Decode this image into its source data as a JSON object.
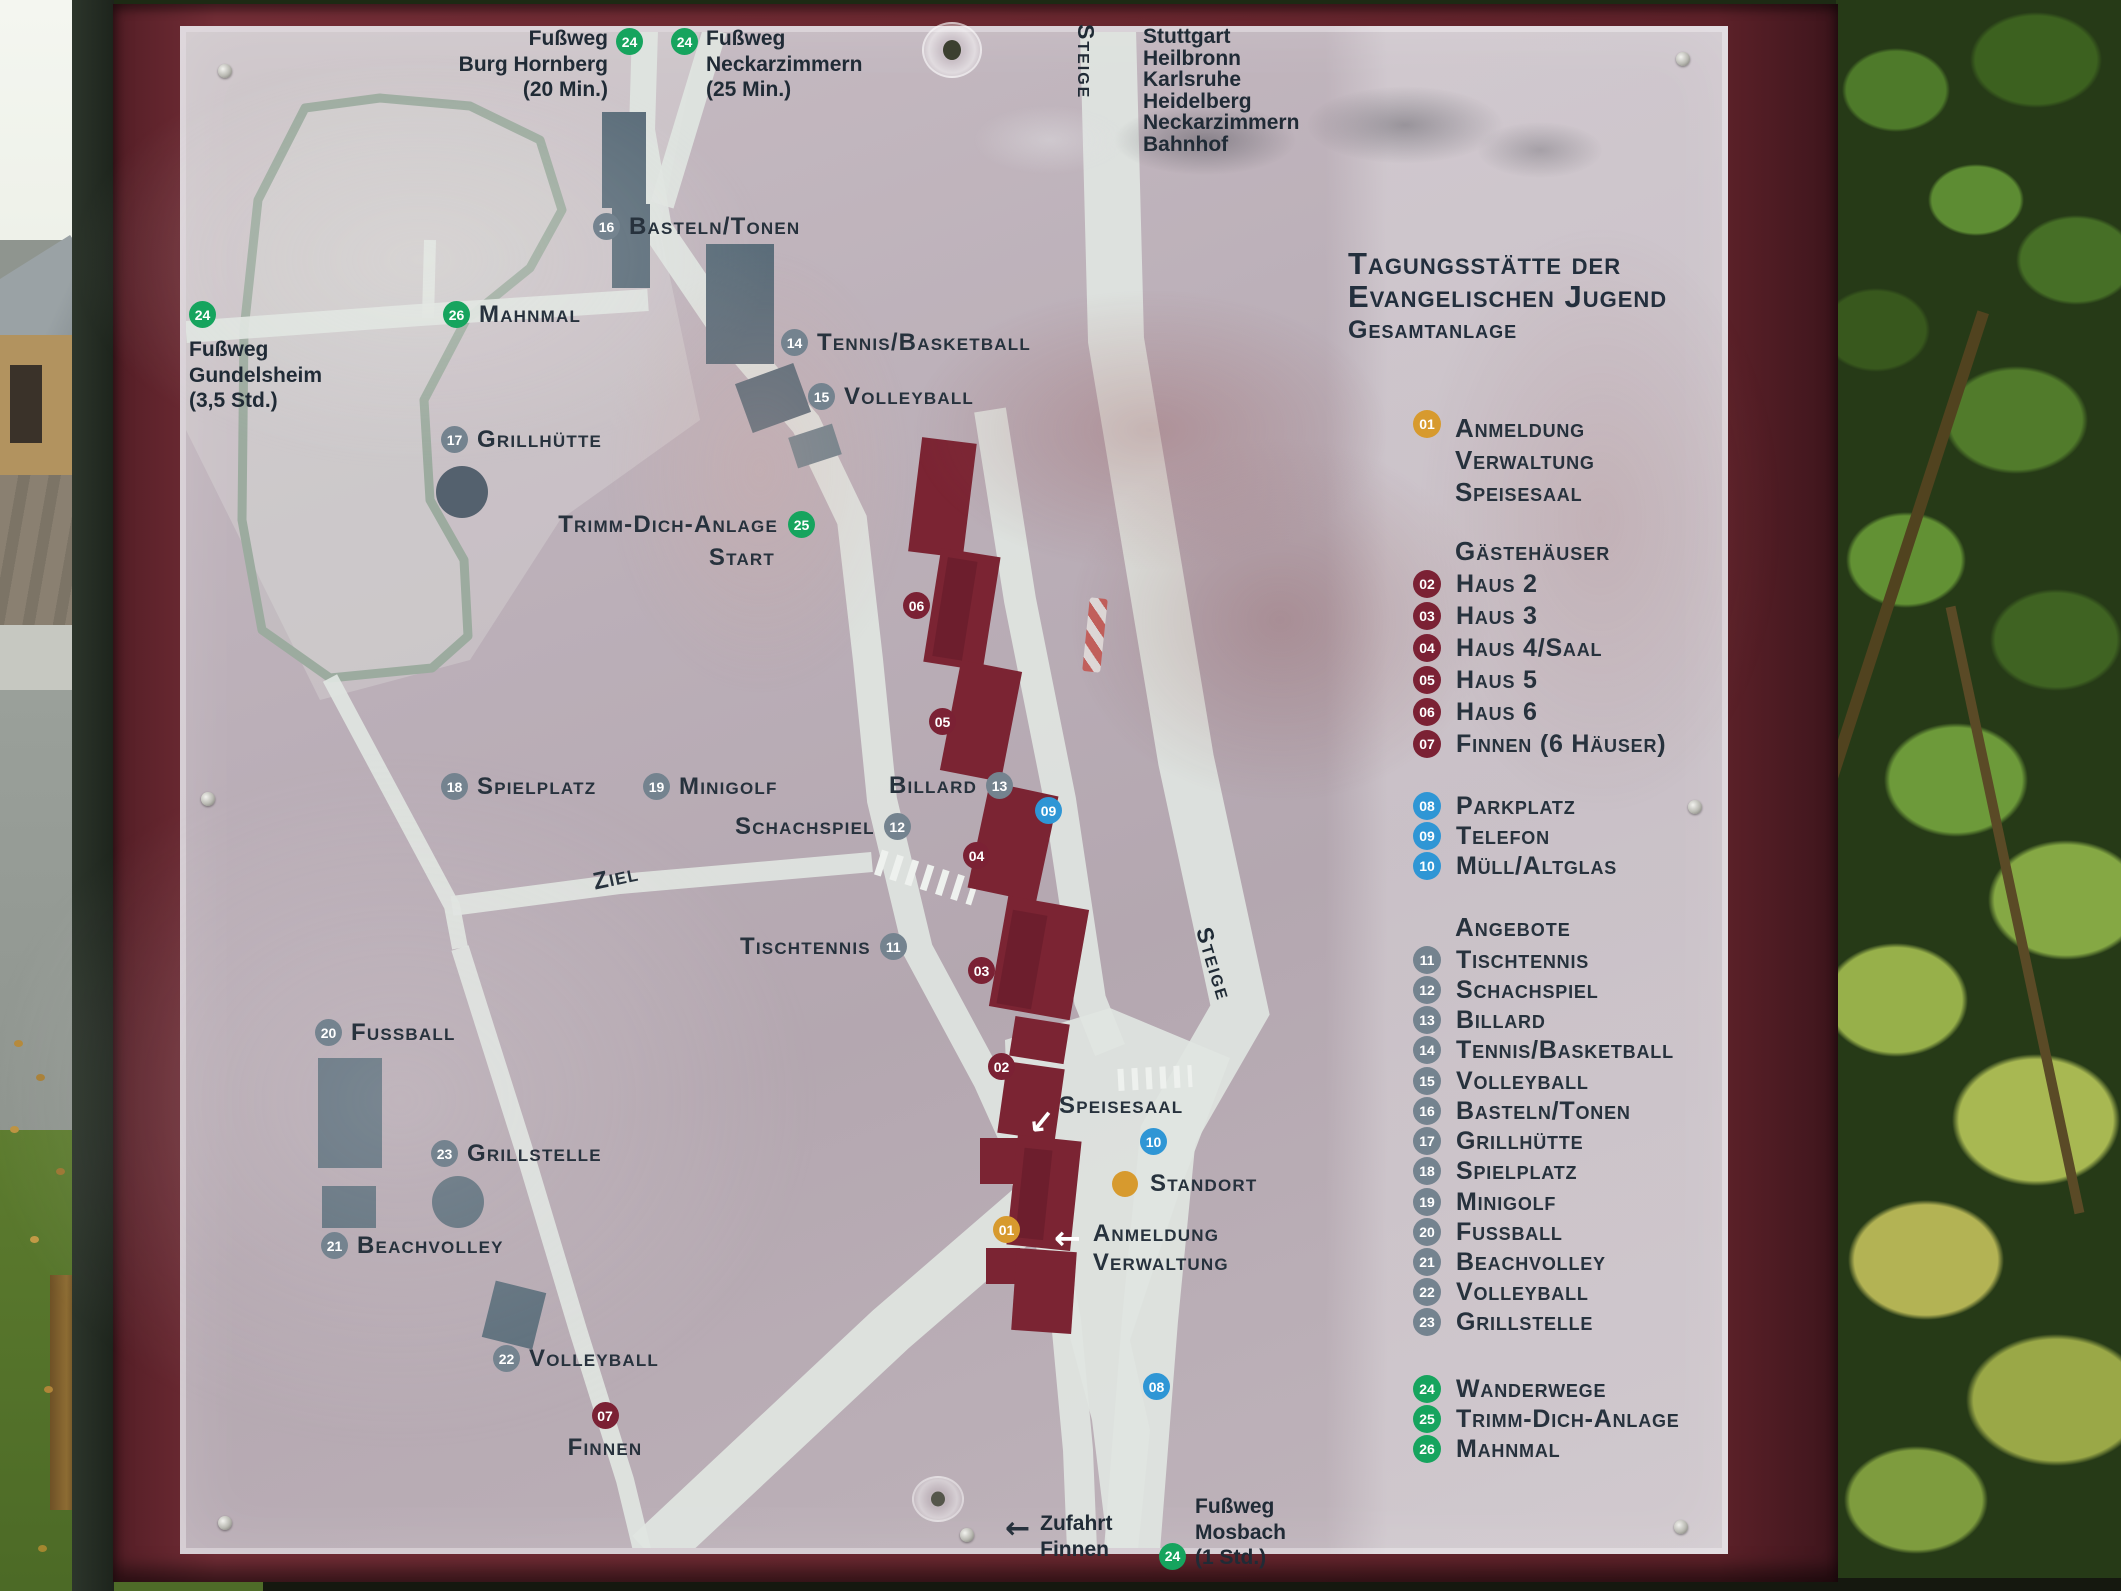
{
  "colors": {
    "frame": "#6b2830",
    "panel": "#bbafb8",
    "building_red": "#7b2433",
    "building_gray": "#5b6d7a",
    "road": "#dfe5e1",
    "badge_red": "#7b2134",
    "badge_blue": "#2f96d5",
    "badge_gray": "#74838f",
    "badge_green": "#16a45e",
    "badge_orange": "#d79a2e",
    "text": "#27323d"
  },
  "sign_title": {
    "line1": "Tagungsstätte der",
    "line2": "Evangelischen Jugend",
    "subtitle": "Gesamtanlage"
  },
  "streets": {
    "steige_top": "Steige",
    "steige_mid": "Steige",
    "destinations": [
      "Stuttgart",
      "Heilbronn",
      "Karlsruhe",
      "Heidelberg",
      "Neckarzimmern",
      "Bahnhof"
    ]
  },
  "walks": {
    "hornberg": {
      "num": "24",
      "lines": [
        "Fußweg",
        "Burg Hornberg",
        "(20 Min.)"
      ]
    },
    "neckarzimmern": {
      "num": "24",
      "lines": [
        "Fußweg",
        "Neckarzimmern",
        "(25 Min.)"
      ]
    },
    "gundelsheim": {
      "num": "24",
      "lines": [
        "Fußweg",
        "Gundelsheim",
        "(3,5 Std.)"
      ]
    },
    "mosbach": {
      "num": "24",
      "lines": [
        "Fußweg",
        "Mosbach",
        "(1 Std.)"
      ]
    },
    "zufahrt": {
      "arrow": "←",
      "lines": [
        "Zufahrt",
        "Finnen"
      ]
    }
  },
  "map": {
    "labels": {
      "mahnmal": {
        "num": "26",
        "text": "Mahnmal"
      },
      "basteln": {
        "num": "16",
        "text": "Basteln/Tonen"
      },
      "tennis": {
        "num": "14",
        "text": "Tennis/Basketball"
      },
      "volleyball15": {
        "num": "15",
        "text": "Volleyball"
      },
      "grillhuette": {
        "num": "17",
        "text": "Grillhütte"
      },
      "trimm": {
        "num": "25",
        "text": "Trimm-Dich-Anlage",
        "text2": "Start"
      },
      "spielplatz": {
        "num": "18",
        "text": "Spielplatz"
      },
      "minigolf": {
        "num": "19",
        "text": "Minigolf"
      },
      "billard": {
        "num": "13",
        "text": "Billard"
      },
      "schachspiel": {
        "num": "12",
        "text": "Schachspiel"
      },
      "ziel": {
        "text": "Ziel"
      },
      "tischtennis": {
        "num": "11",
        "text": "Tischtennis"
      },
      "fussball": {
        "num": "20",
        "text": "Fussball"
      },
      "grillstelle": {
        "num": "23",
        "text": "Grillstelle"
      },
      "beachvolley": {
        "num": "21",
        "text": "Beachvolley"
      },
      "volleyball22": {
        "num": "22",
        "text": "Volleyball"
      },
      "finnen": {
        "num": "07",
        "text": "Finnen"
      },
      "speisesaal": {
        "text": "Speisesaal",
        "arrow": "↙"
      },
      "standort": {
        "text": "Standort"
      },
      "anmeldung": {
        "num": "01",
        "arrow": "←",
        "line1": "Anmeldung",
        "line2": "Verwaltung"
      }
    },
    "badges": {
      "b02": "02",
      "b03": "03",
      "b04": "04",
      "b05": "05",
      "b06": "06",
      "b08": "08",
      "b09": "09",
      "b10": "10"
    }
  },
  "legend": {
    "reception": {
      "num": "01",
      "lines": [
        "Anmeldung",
        "Verwaltung",
        "Speisesaal"
      ]
    },
    "guesthouses_heading": "Gästehäuser",
    "guesthouses": [
      {
        "num": "02",
        "label": "Haus 2"
      },
      {
        "num": "03",
        "label": "Haus 3"
      },
      {
        "num": "04",
        "label": "Haus 4/Saal"
      },
      {
        "num": "05",
        "label": "Haus 5"
      },
      {
        "num": "06",
        "label": "Haus 6"
      },
      {
        "num": "07",
        "label": "Finnen (6 Häuser)"
      }
    ],
    "facilities": [
      {
        "num": "08",
        "label": "Parkplatz"
      },
      {
        "num": "09",
        "label": "Telefon"
      },
      {
        "num": "10",
        "label": "Müll/Altglas"
      }
    ],
    "angebote_heading": "Angebote",
    "angebote": [
      {
        "num": "11",
        "label": "Tischtennis"
      },
      {
        "num": "12",
        "label": "Schachspiel"
      },
      {
        "num": "13",
        "label": "Billard"
      },
      {
        "num": "14",
        "label": "Tennis/Basketball"
      },
      {
        "num": "15",
        "label": "Volleyball"
      },
      {
        "num": "16",
        "label": "Basteln/Tonen"
      },
      {
        "num": "17",
        "label": "Grillhütte"
      },
      {
        "num": "18",
        "label": "Spielplatz"
      },
      {
        "num": "19",
        "label": "Minigolf"
      },
      {
        "num": "20",
        "label": "Fussball"
      },
      {
        "num": "21",
        "label": "Beachvolley"
      },
      {
        "num": "22",
        "label": "Volleyball"
      },
      {
        "num": "23",
        "label": "Grillstelle"
      }
    ],
    "wander": [
      {
        "num": "24",
        "label": "Wanderwege"
      },
      {
        "num": "25",
        "label": "Trimm-Dich-Anlage"
      },
      {
        "num": "26",
        "label": "Mahnmal"
      }
    ]
  }
}
